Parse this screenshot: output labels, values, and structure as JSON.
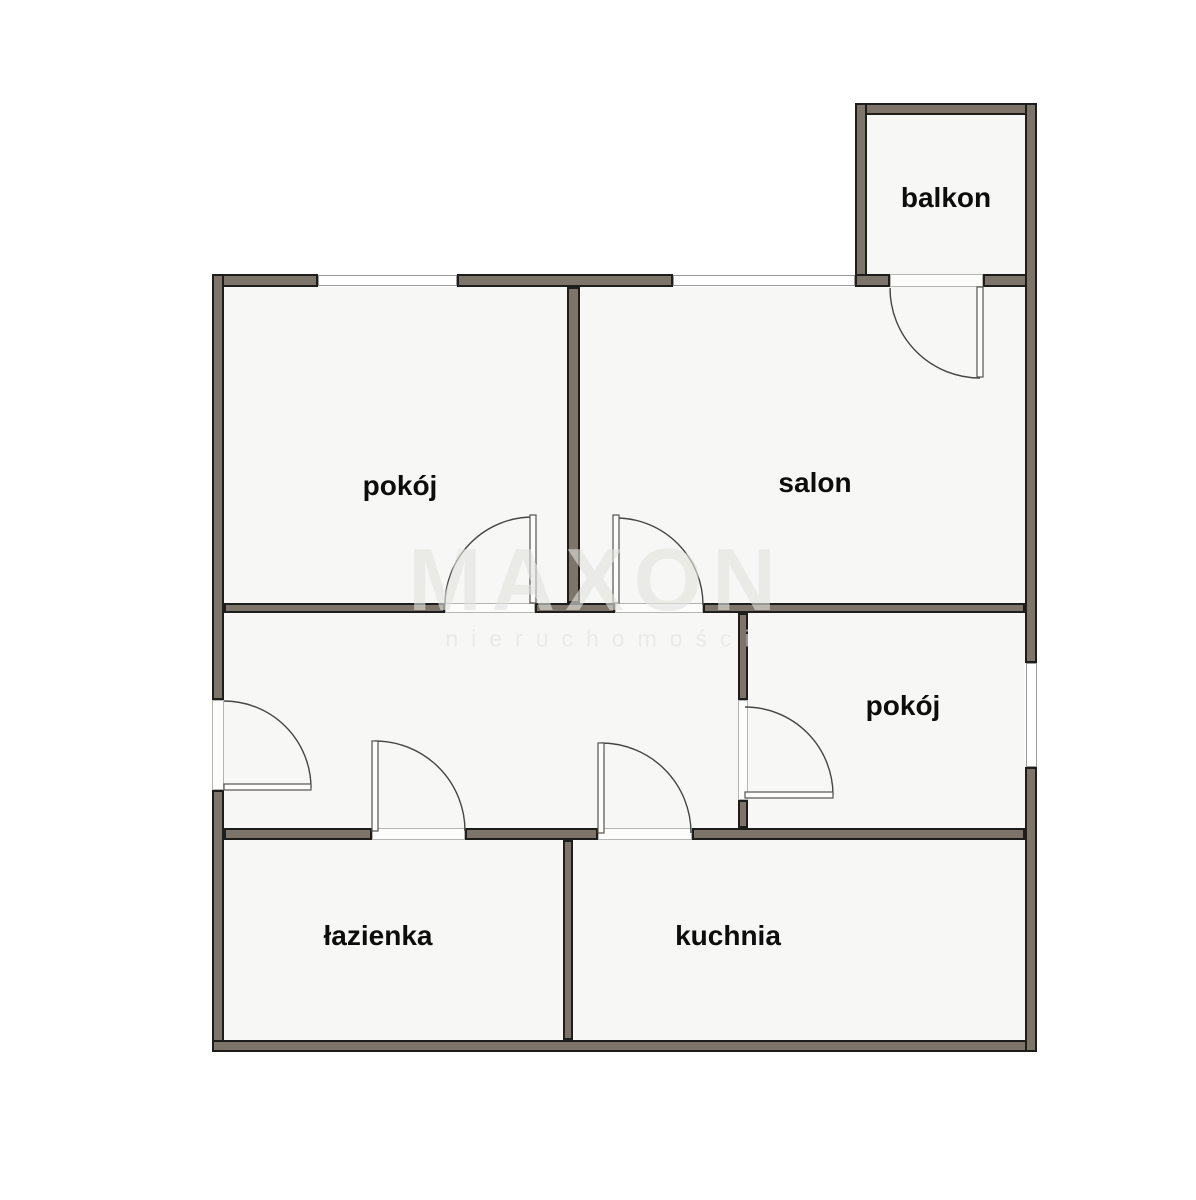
{
  "rooms": [
    {
      "id": "balkon",
      "label": "balkon"
    },
    {
      "id": "pokoj_top",
      "label": "pokój"
    },
    {
      "id": "salon",
      "label": "salon"
    },
    {
      "id": "pokoj_right",
      "label": "pokój"
    },
    {
      "id": "lazienka",
      "label": "łazienka"
    },
    {
      "id": "kuchnia",
      "label": "kuchnia"
    }
  ],
  "watermark": {
    "brand": "MAXON",
    "subtitle": "nieruchomości"
  },
  "colors": {
    "wall_fill": "#7d7569",
    "wall_outline": "#1d1d1b",
    "floor": "#f7f7f5",
    "background": "#ffffff",
    "label": "#0d0d0d",
    "door_line": "#454543",
    "frame_line": "#9b9b99",
    "watermark": "rgba(226,226,223,0.62)"
  }
}
